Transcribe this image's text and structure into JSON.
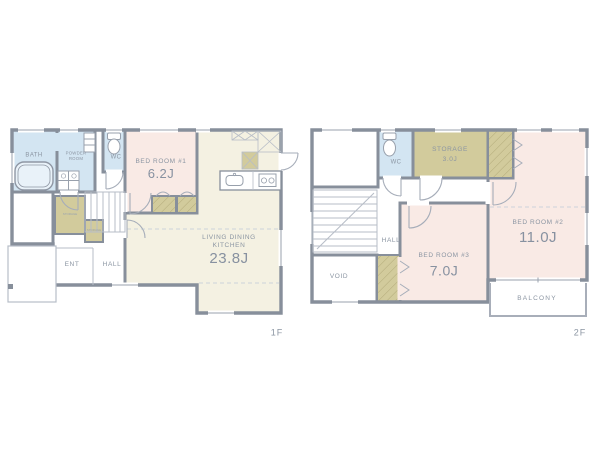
{
  "floor1": {
    "floor_label": "1F",
    "bath": "BATH",
    "powder": "POWDER ROOM",
    "wc": "WC",
    "bedroom1_name": "BED ROOM #1",
    "bedroom1_size": "6.2J",
    "ldk_line1": "LIVING DINING",
    "ldk_line2": "KITCHEN",
    "ldk_size": "23.8J",
    "ent": "ENT",
    "hall": "HALL",
    "closet1": "STORAGE",
    "closet2": "STORAGE"
  },
  "floor2": {
    "floor_label": "2F",
    "wc": "WC",
    "storage_name": "STORAGE",
    "storage_size": "3.0J",
    "bedroom2_name": "BED ROOM #2",
    "bedroom2_size": "11.0J",
    "bedroom3_name": "BED ROOM #3",
    "bedroom3_size": "7.0J",
    "hall": "HALL",
    "void": "VOID",
    "balcony": "BALCONY"
  },
  "colors": {
    "wall": "#878f9b",
    "water_room_blue": "#d3e5f2",
    "bedroom_pink": "#f9eae5",
    "ldk_cream": "#f4f1e2",
    "storage_khaki": "#d2cb9c",
    "label_gray": "#8b95a2",
    "thin_line": "#b7bdc7"
  },
  "icons": {
    "bathtub": "rounded-rect outline",
    "toilet": "tank + bowl ellipse",
    "washing_machine": "grid square with drums",
    "kitchen_sink": "rounded rect + faucet dot",
    "stove": "rect with two burners",
    "stairs": "tread lines",
    "door": "quarter-circle swing arc",
    "closet_hatch": "diagonal line fill",
    "window": "thin double line in wall gap"
  }
}
